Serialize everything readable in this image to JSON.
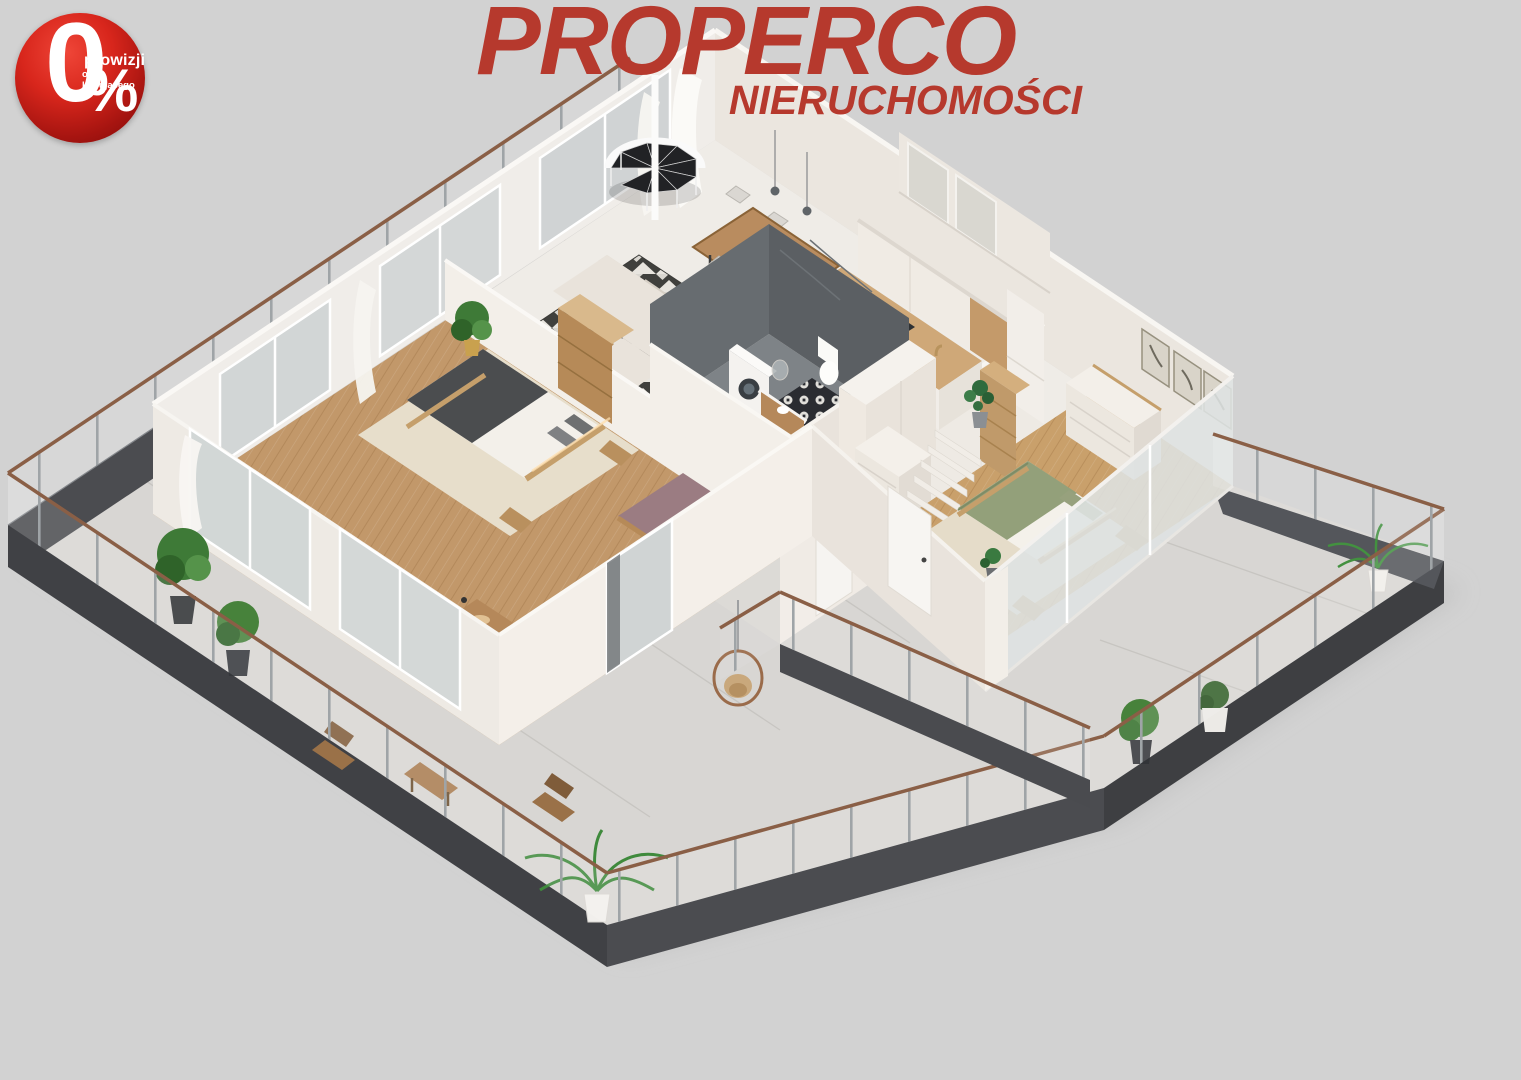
{
  "page": {
    "background_color": "#d2d2d2",
    "width": 1521,
    "height": 1080
  },
  "badge": {
    "zero": "0",
    "percent": "%",
    "line1": "prowizji",
    "line2": "od kupującego",
    "color_bright": "#ef4638",
    "color_dark": "#7c0b08",
    "text_color": "#ffffff"
  },
  "logo": {
    "title": "PROPERCO",
    "subtitle": "NIERUCHOMOŚCI",
    "color": "#b6392d"
  },
  "scene": {
    "type": "isometric-3d-floorplan-render",
    "palette": {
      "background": "#d2d2d2",
      "wall_light": "#f3efe9",
      "wall_shadow": "#e9e3dc",
      "floor_marble": "#efece7",
      "floor_wood": "#c2986a",
      "terrace_floor": "#d8d6d3",
      "slab_dark": "#46474b",
      "railing_copper": "#8a5f46",
      "plant_green": "#3e7a37",
      "bed_left_blanket": "#4b4d4f",
      "bed_right_blanket": "#93a07a",
      "daybed_plum": "#9b7c82",
      "bathroom_slate": "#5b5f63"
    },
    "rooms": [
      "living-room",
      "dining-area",
      "kitchen",
      "hallway",
      "bathroom",
      "bedroom-left",
      "guest-room-office",
      "bedroom-right",
      "wraparound-terrace",
      "balcony-spiral-staircase"
    ]
  }
}
